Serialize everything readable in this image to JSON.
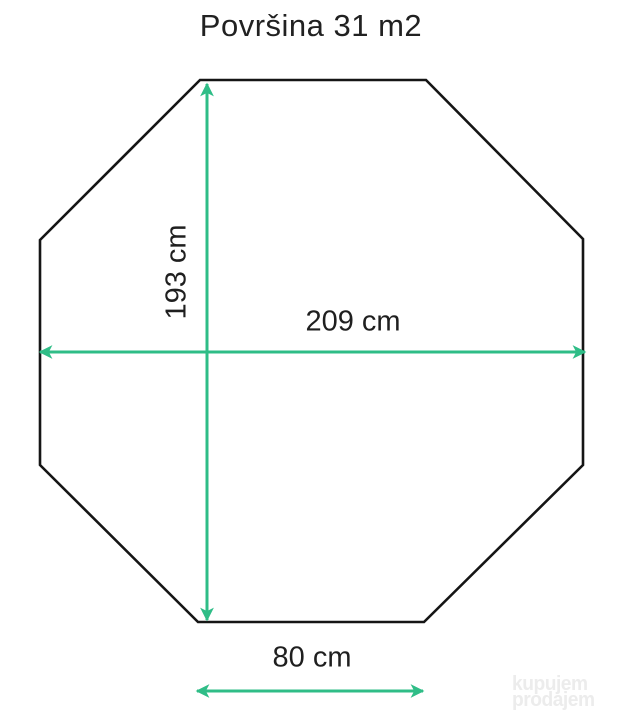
{
  "title": "Površina 31 m2",
  "diagram": {
    "shape": "octagon",
    "outline_color": "#151515",
    "arrow_color": "#2fbd87",
    "vertices": [
      [
        200,
        80
      ],
      [
        426,
        80
      ],
      [
        583,
        239
      ],
      [
        583,
        465
      ],
      [
        424,
        622
      ],
      [
        198,
        622
      ],
      [
        40,
        465
      ],
      [
        40,
        240
      ]
    ],
    "dimensions": [
      {
        "label": "193 cm",
        "orientation": "vertical",
        "from": [
          207,
          84
        ],
        "to": [
          207,
          620
        ]
      },
      {
        "label": "209 cm",
        "orientation": "horizontal",
        "from": [
          40,
          352
        ],
        "to": [
          585,
          352
        ]
      },
      {
        "label": "80 cm",
        "orientation": "horizontal",
        "from": [
          197,
          691
        ],
        "to": [
          423,
          691
        ]
      }
    ]
  },
  "watermark": {
    "line1": "kupujem",
    "line2": "prodajem"
  }
}
